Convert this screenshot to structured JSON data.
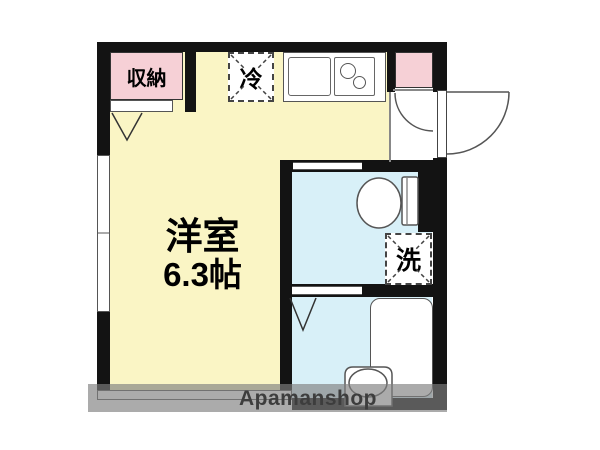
{
  "floorplan": {
    "main_room": {
      "name": "洋室",
      "size": "6.3帖"
    },
    "closet_label": "収納",
    "refrigerator_label": "冷",
    "washer_label": "洗",
    "watermark": "Apamanshop"
  },
  "colors": {
    "wall": "#131313",
    "main_room_fill": "#faf5c5",
    "closet_fill": "#f6d0d6",
    "wet_area_fill": "#d8f0f8",
    "line": "#555555",
    "watermark_band": "rgba(128,128,128,0.66)",
    "watermark_text": "#3d3d3d"
  }
}
